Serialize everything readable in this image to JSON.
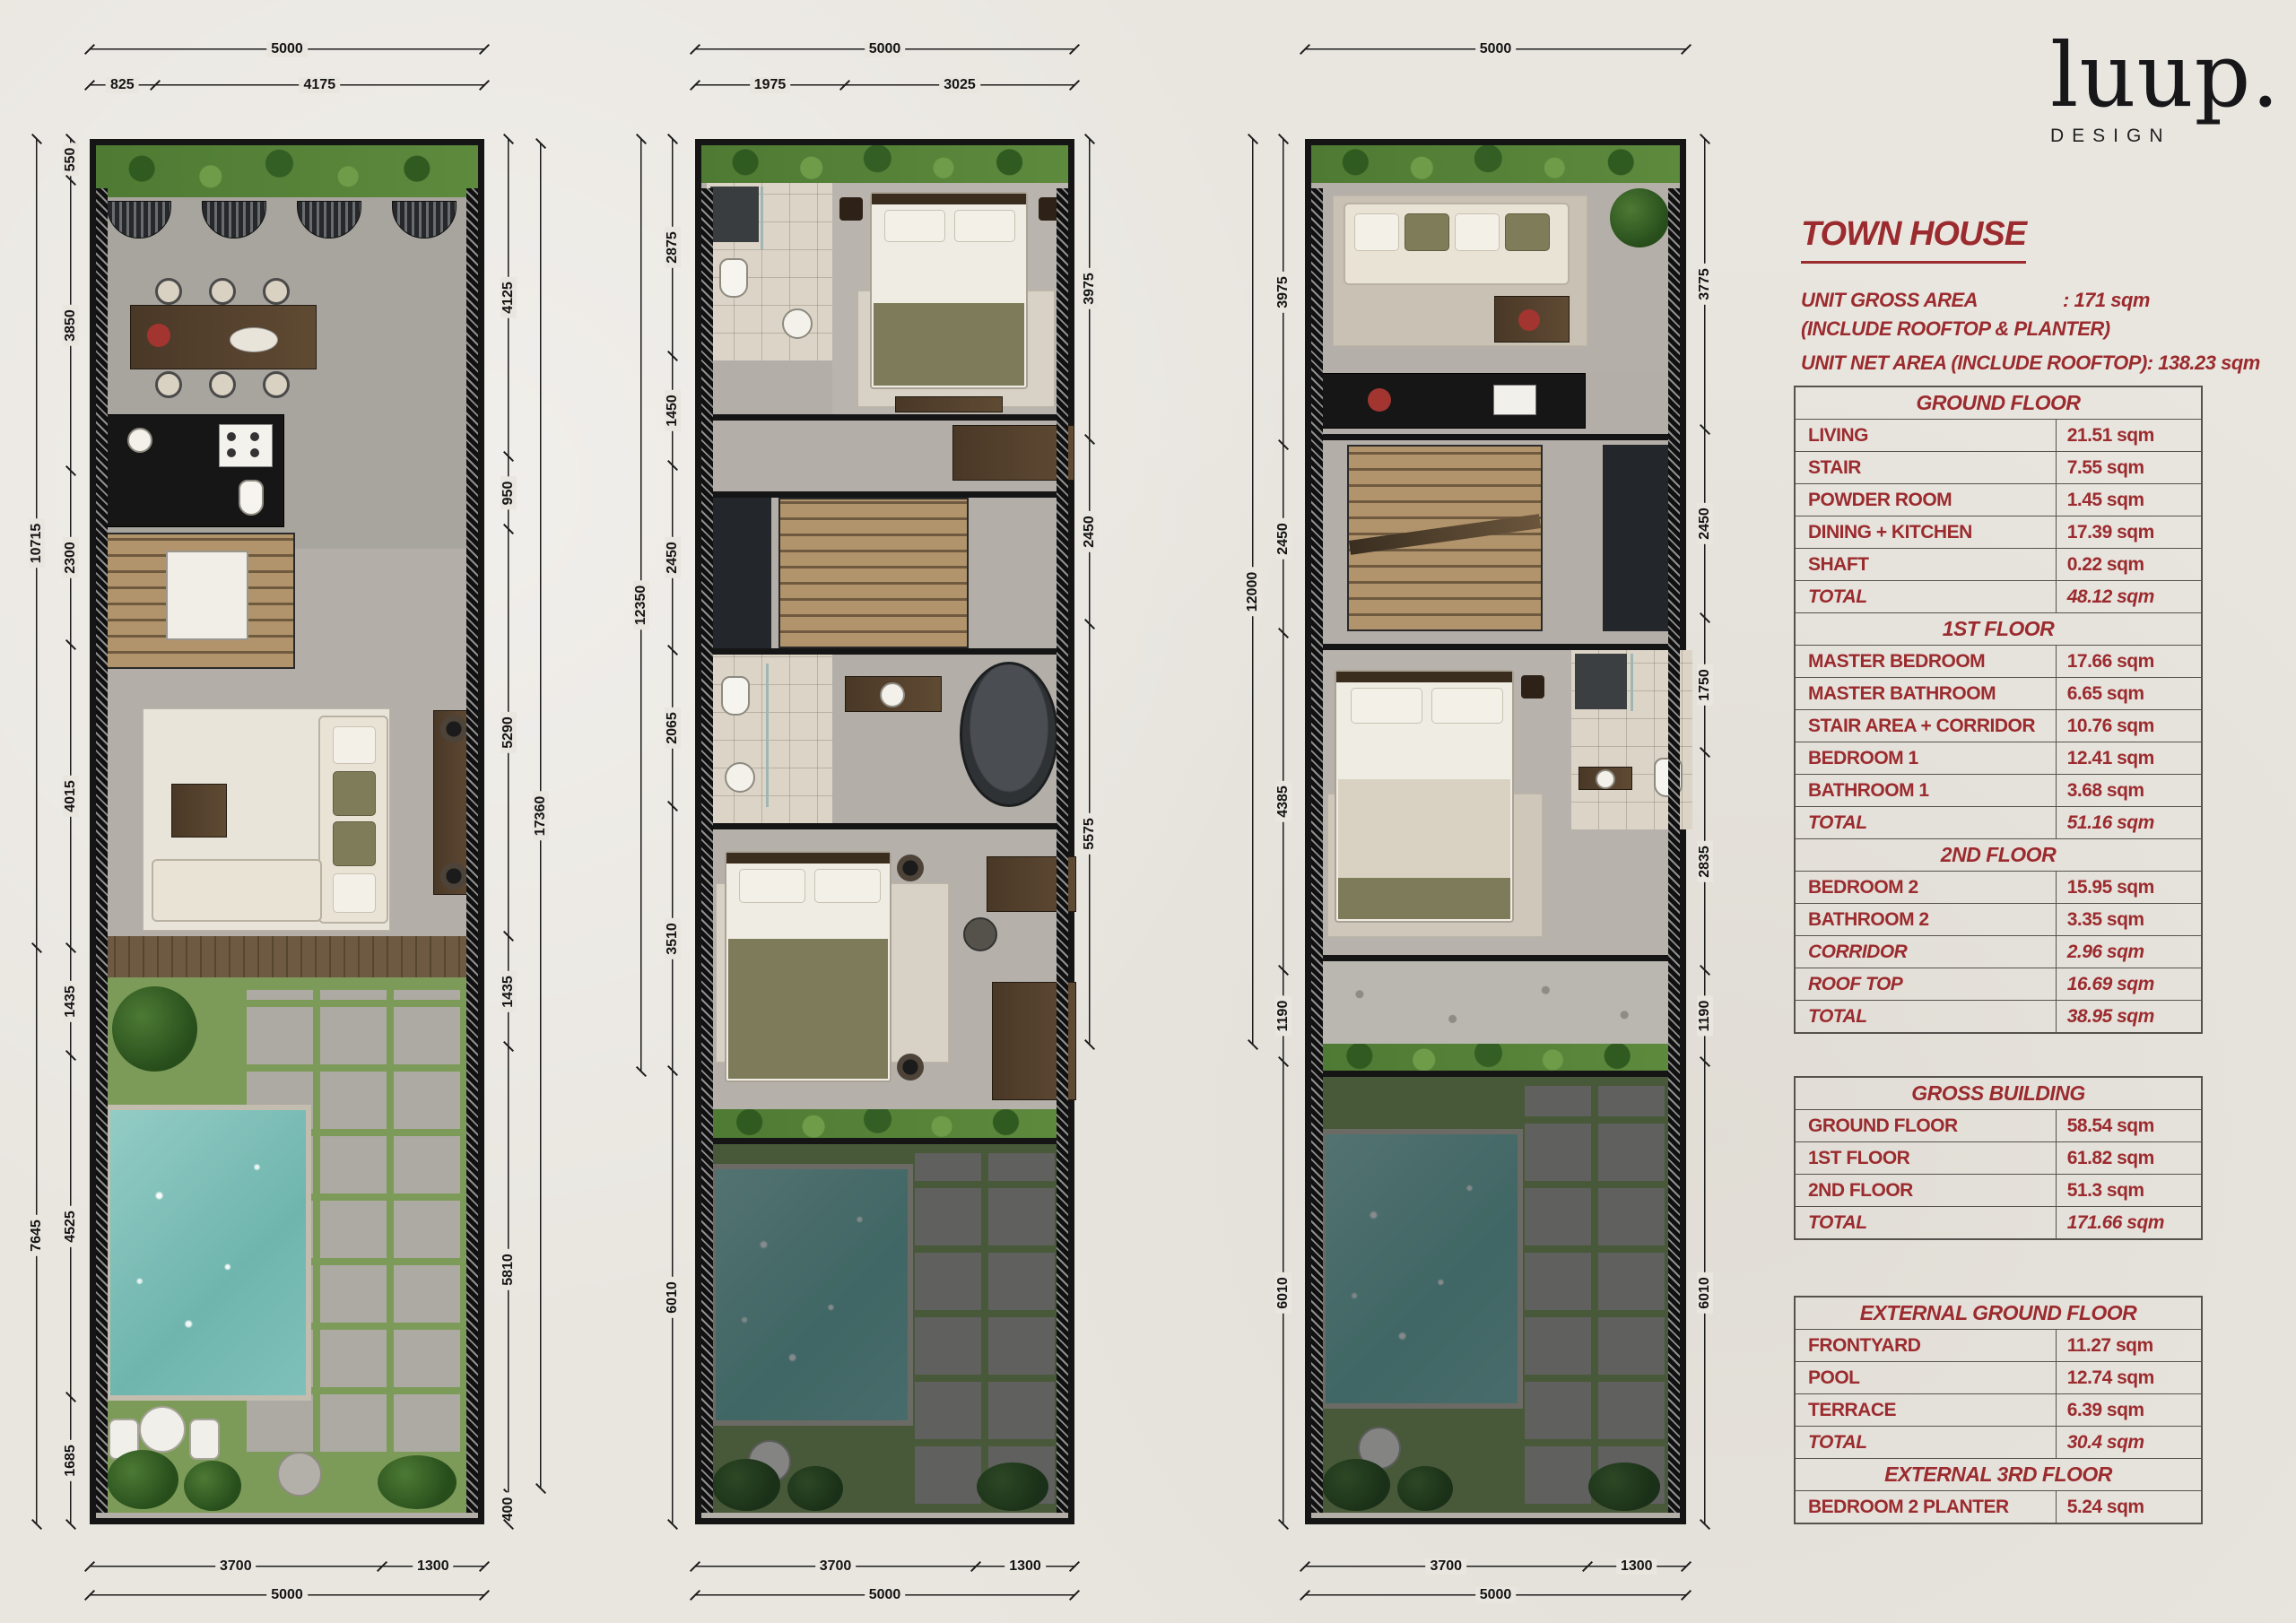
{
  "logo": {
    "word": "luup.",
    "sub": "DESIGN"
  },
  "panel": {
    "title": "TOWN HOUSE",
    "gross_label": "UNIT GROSS AREA",
    "gross_value": ": 171 sqm",
    "gross_note": "(INCLUDE ROOFTOP & PLANTER)",
    "net_line": "UNIT NET AREA (INCLUDE ROOFTOP): 138.23 sqm"
  },
  "tables": [
    {
      "rows": [
        {
          "h": "GROUND FLOOR"
        },
        {
          "l": "LIVING",
          "v": "21.51 sqm"
        },
        {
          "l": "STAIR",
          "v": "7.55 sqm"
        },
        {
          "l": "POWDER ROOM",
          "v": "1.45 sqm"
        },
        {
          "l": "DINING + KITCHEN",
          "v": "17.39 sqm"
        },
        {
          "l": "SHAFT",
          "v": "0.22 sqm"
        },
        {
          "l": "TOTAL",
          "v": "48.12 sqm",
          "i": true
        },
        {
          "h": "1ST FLOOR"
        },
        {
          "l": "MASTER BEDROOM",
          "v": "17.66 sqm"
        },
        {
          "l": "MASTER BATHROOM",
          "v": "6.65 sqm"
        },
        {
          "l": "STAIR AREA + CORRIDOR",
          "v": "10.76 sqm"
        },
        {
          "l": "BEDROOM 1",
          "v": "12.41 sqm"
        },
        {
          "l": "BATHROOM 1",
          "v": "3.68 sqm"
        },
        {
          "l": "TOTAL",
          "v": "51.16 sqm",
          "i": true
        },
        {
          "h": "2ND FLOOR"
        },
        {
          "l": "BEDROOM 2",
          "v": "15.95 sqm"
        },
        {
          "l": "BATHROOM 2",
          "v": "3.35 sqm"
        },
        {
          "l": "CORRIDOR",
          "v": "2.96 sqm",
          "i": true
        },
        {
          "l": "ROOF TOP",
          "v": "16.69 sqm",
          "i": true
        },
        {
          "l": "TOTAL",
          "v": "38.95 sqm",
          "i": true
        }
      ]
    },
    {
      "rows": [
        {
          "h": "GROSS BUILDING"
        },
        {
          "l": "GROUND FLOOR",
          "v": "58.54 sqm"
        },
        {
          "l": "1ST FLOOR",
          "v": "61.82 sqm"
        },
        {
          "l": "2ND FLOOR",
          "v": "51.3 sqm"
        },
        {
          "l": "TOTAL",
          "v": "171.66 sqm",
          "i": true
        }
      ]
    },
    {
      "rows": [
        {
          "h": "EXTERNAL GROUND FLOOR"
        },
        {
          "l": "FRONTYARD",
          "v": "11.27 sqm"
        },
        {
          "l": "POOL",
          "v": "12.74 sqm"
        },
        {
          "l": "TERRACE",
          "v": "6.39 sqm"
        },
        {
          "l": "TOTAL",
          "v": "30.4 sqm",
          "i": true
        },
        {
          "h": "EXTERNAL 3RD FLOOR"
        },
        {
          "l": "BEDROOM 2 PLANTER",
          "v": "5.24 sqm"
        }
      ]
    }
  ],
  "plans": [
    {
      "name": "ground floor plan",
      "top_overall": [
        {
          "t": "5000",
          "v": 5000
        }
      ],
      "top_inner": [
        {
          "t": "825",
          "v": 825
        },
        {
          "t": "4175",
          "v": 4175
        }
      ],
      "left_outer": [
        {
          "t": "10715",
          "v": 10715
        },
        {
          "t": "7645",
          "v": 7645
        }
      ],
      "left_inner": [
        {
          "t": "550",
          "v": 550
        },
        {
          "t": "3850",
          "v": 3850
        },
        {
          "t": "2300",
          "v": 2300
        },
        {
          "t": "4015",
          "v": 4015
        },
        {
          "t": "1435",
          "v": 1435
        },
        {
          "t": "4525",
          "v": 4525
        },
        {
          "t": "1685",
          "v": 1685
        }
      ],
      "right_inner": [
        {
          "t": "4125",
          "v": 4125
        },
        {
          "t": "950",
          "v": 950
        },
        {
          "t": "5290",
          "v": 5290
        },
        {
          "t": "1435",
          "v": 1435
        },
        {
          "t": "5810",
          "v": 5810
        },
        {
          "t": "400",
          "v": 400
        }
      ],
      "right_outer": [
        {
          "t": "17360",
          "v": 17360
        }
      ],
      "bottom_inner": [
        {
          "t": "3700",
          "v": 3700
        },
        {
          "t": "1300",
          "v": 1300
        }
      ],
      "bottom_overall": [
        {
          "t": "5000",
          "v": 5000
        }
      ]
    },
    {
      "name": "first floor plan",
      "top_overall": [
        {
          "t": "5000",
          "v": 5000
        }
      ],
      "top_inner": [
        {
          "t": "1975",
          "v": 1975
        },
        {
          "t": "3025",
          "v": 3025
        }
      ],
      "left_outer": [
        {
          "t": "12350",
          "v": 12350
        }
      ],
      "left_inner": [
        {
          "t": "2875",
          "v": 2875
        },
        {
          "t": "1450",
          "v": 1450
        },
        {
          "t": "2450",
          "v": 2450
        },
        {
          "t": "2065",
          "v": 2065
        },
        {
          "t": "3510",
          "v": 3510
        },
        {
          "t": "6010",
          "v": 6010
        }
      ],
      "right_inner": [
        {
          "t": "3975",
          "v": 3975
        },
        {
          "t": "2450",
          "v": 2450
        },
        {
          "t": "5575",
          "v": 5575
        }
      ],
      "bottom_inner": [
        {
          "t": "3700",
          "v": 3700
        },
        {
          "t": "1300",
          "v": 1300
        }
      ],
      "bottom_overall": [
        {
          "t": "5000",
          "v": 5000
        }
      ]
    },
    {
      "name": "second floor plan",
      "top_overall": [
        {
          "t": "5000",
          "v": 5000
        }
      ],
      "left_outer": [
        {
          "t": "12000",
          "v": 12000
        }
      ],
      "left_inner": [
        {
          "t": "3975",
          "v": 3975
        },
        {
          "t": "2450",
          "v": 2450
        },
        {
          "t": "4385",
          "v": 4385
        },
        {
          "t": "1190",
          "v": 1190
        },
        {
          "t": "6010",
          "v": 6010
        }
      ],
      "right_inner": [
        {
          "t": "3775",
          "v": 3775
        },
        {
          "t": "2450",
          "v": 2450
        },
        {
          "t": "1750",
          "v": 1750
        },
        {
          "t": "2835",
          "v": 2835
        },
        {
          "t": "1190",
          "v": 1190
        },
        {
          "t": "6010",
          "v": 6010
        }
      ],
      "bottom_inner": [
        {
          "t": "3700",
          "v": 3700
        },
        {
          "t": "1300",
          "v": 1300
        }
      ],
      "bottom_overall": [
        {
          "t": "5000",
          "v": 5000
        }
      ]
    }
  ]
}
